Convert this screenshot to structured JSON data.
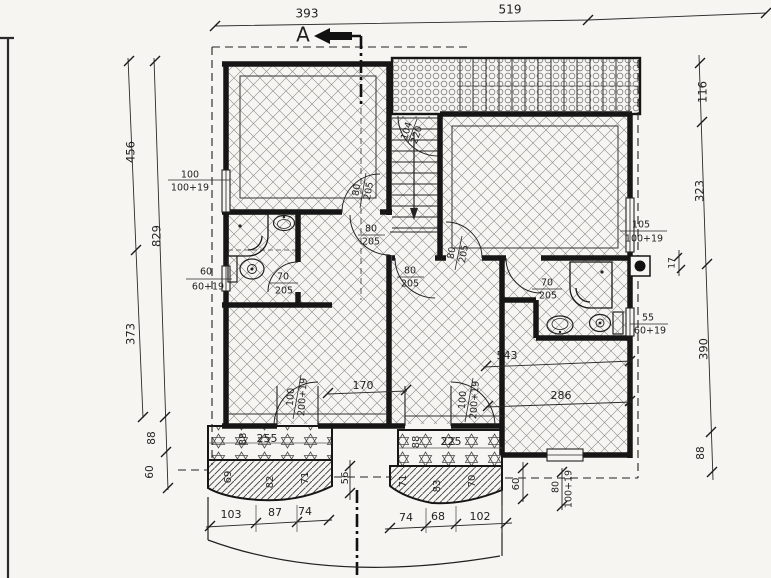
{
  "section": {
    "label": "A"
  },
  "dims": {
    "top": [
      "393",
      "519"
    ],
    "left_outer": [
      "456",
      "373"
    ],
    "left_inner": [
      "829",
      "88",
      "60"
    ],
    "right": [
      "116",
      "323",
      "17",
      "390",
      "88"
    ],
    "interior": [
      "170",
      "543",
      "286"
    ],
    "bottom_left": [
      "103",
      "87",
      "74"
    ],
    "bottom_right": [
      "74",
      "68",
      "102"
    ],
    "misc": {
      "gap": "56",
      "right_step": "60"
    }
  },
  "windows": {
    "left_top": {
      "w": "100",
      "h": "100+19"
    },
    "left_mid": {
      "w": "60",
      "h": "60+19"
    },
    "right_top": {
      "w": "105",
      "h": "100+19"
    },
    "right_mid": {
      "w": "55",
      "h": "60+19"
    },
    "bottom_right": {
      "w": "80",
      "h": "100+19"
    }
  },
  "doors": {
    "stair_top": {
      "w": "104",
      "h": "220"
    },
    "room_upper": {
      "w": "80",
      "h": "205"
    },
    "stairs": {
      "w": "80",
      "h": "205"
    },
    "room_right": {
      "w": "80",
      "h": "205"
    },
    "room_center": {
      "w": "80",
      "h": "205"
    },
    "bath_left": {
      "w": "70",
      "h": "205"
    },
    "bath_right": {
      "w": "70",
      "h": "205"
    },
    "balcony_left": {
      "w": "100",
      "h": "200+19"
    },
    "balcony_right": {
      "w": "100",
      "h": "200+19"
    }
  },
  "balcony_left": {
    "width_label": "255",
    "depth_label": "88",
    "edge": [
      "69",
      "82",
      "71"
    ]
  },
  "balcony_right": {
    "width_label": "225",
    "depth_label": "88",
    "edge": [
      "71",
      "83",
      "70"
    ]
  }
}
